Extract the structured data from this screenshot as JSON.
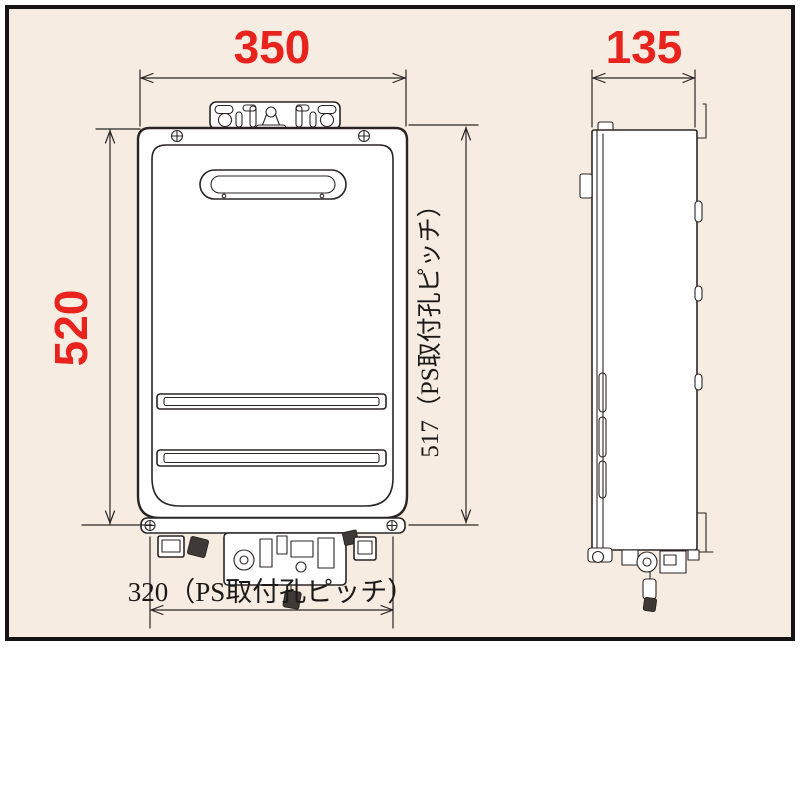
{
  "colors": {
    "background": "#f6ece2",
    "frame": "#151313",
    "line": "#2a2524",
    "red": "#e8231e",
    "body_fill": "#ffffff"
  },
  "front_view": {
    "width_label": "350",
    "height_label": "520",
    "ps_pitch_vertical_label": "517（PS取付孔ピッチ）",
    "ps_pitch_horizontal_label": "320（PS取付孔ピッチ）"
  },
  "side_view": {
    "depth_label": "135"
  }
}
